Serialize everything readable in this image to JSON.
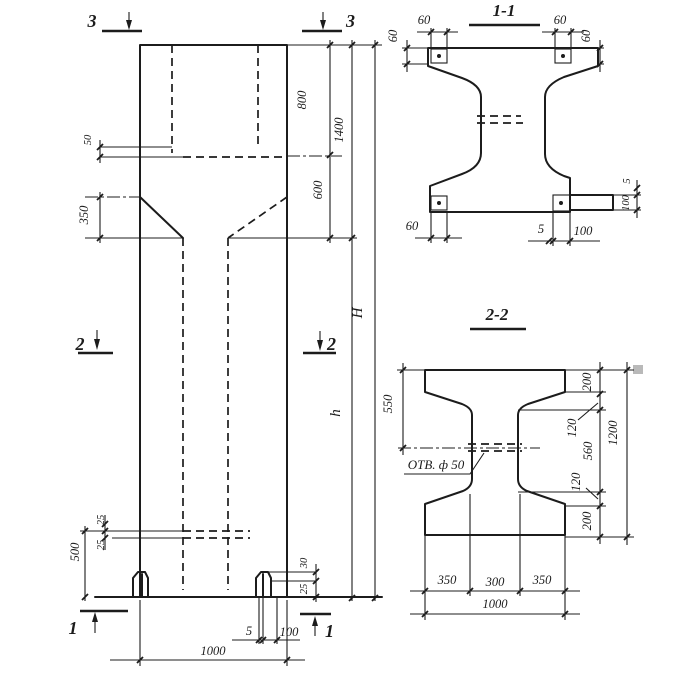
{
  "colors": {
    "ink": "#1c1c1c",
    "paper": "#ffffff",
    "artifact": "#b9b9b9"
  },
  "elevation": {
    "marks": {
      "m3l": "3",
      "m3r": "3",
      "m2l": "2",
      "m2r": "2",
      "m1l": "1",
      "m1r": "1"
    },
    "dims": {
      "d50": "50",
      "d350": "350",
      "d800": "800",
      "d1400": "1400",
      "d600": "600",
      "H": "H",
      "h": "h",
      "d25a": "25",
      "d25b": "25",
      "d500": "500",
      "d30": "30",
      "d25c": "25",
      "d5": "5",
      "d100": "100",
      "d1000": "1000"
    }
  },
  "section11": {
    "title": "1-1",
    "dims": {
      "tl_w": "60",
      "tl_h": "60",
      "tr_w": "60",
      "tr_h": "60",
      "bl": "60",
      "r5": "5",
      "r100": "100",
      "b5": "5",
      "b100": "100"
    }
  },
  "section22": {
    "title": "2-2",
    "hole": "ОТВ. ф 50",
    "dims": {
      "d550": "550",
      "t200": "200",
      "t120": "120",
      "d560": "560",
      "b120": "120",
      "b200": "200",
      "d1200": "1200",
      "w350l": "350",
      "w300": "300",
      "w350r": "350",
      "w1000": "1000"
    }
  }
}
